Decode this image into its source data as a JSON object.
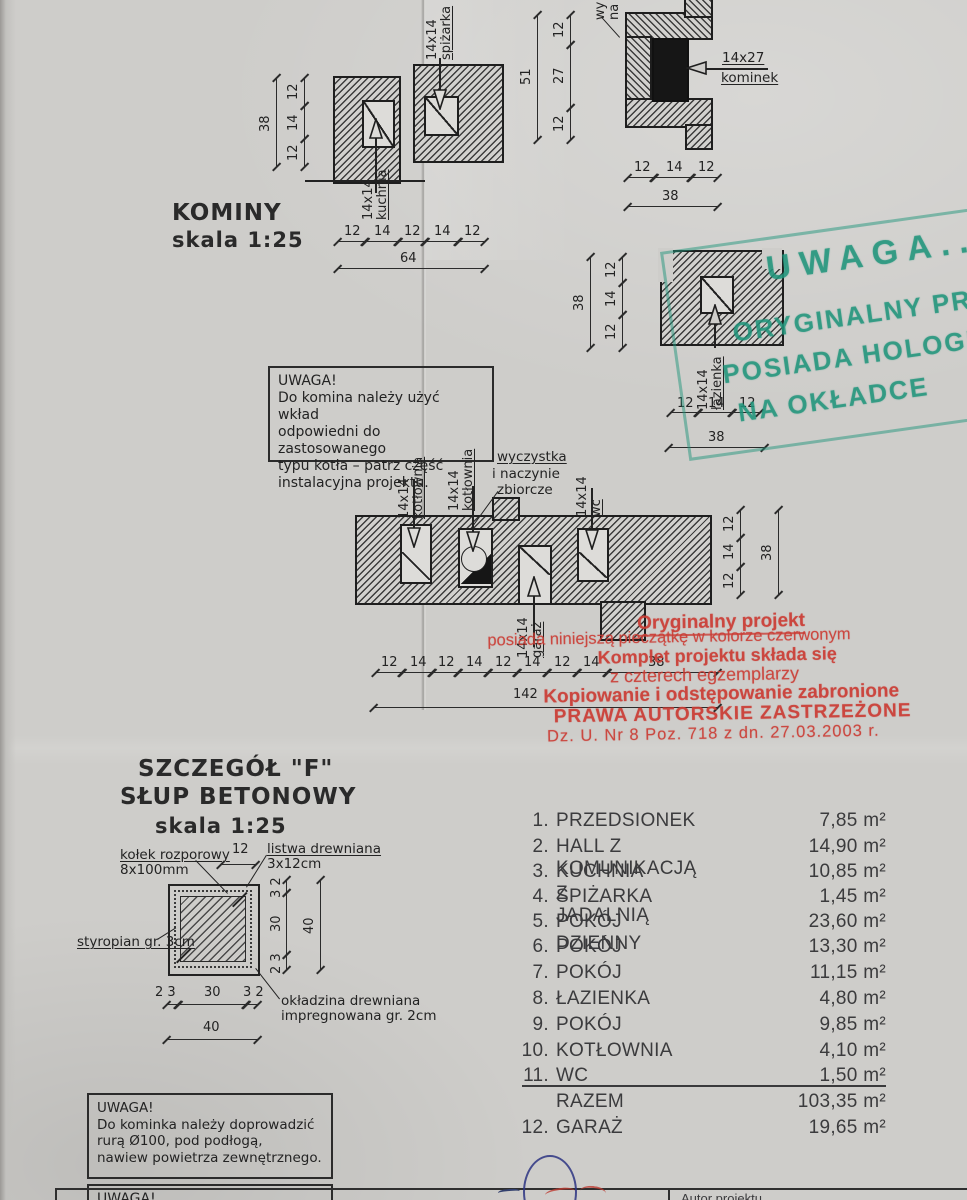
{
  "kominy": {
    "title": "KOMINY",
    "scale": "skala 1:25",
    "c1": {
      "flue_top_label1": "14x14",
      "flue_top_label2": "spiżarka",
      "flue_bottom_label1": "14x14",
      "flue_bottom_label2": "kuchnia",
      "dims_left": [
        "12",
        "14",
        "12"
      ],
      "dims_left_total": "38",
      "dims_bottom": [
        "12",
        "14",
        "12",
        "14",
        "12"
      ],
      "dims_bottom_total": "64"
    },
    "c2": {
      "flue_label1": "14x27",
      "flue_label2": "kominek",
      "partial_label1": "wy",
      "partial_label2": "na",
      "dims_left": [
        "12",
        "27",
        "12"
      ],
      "dims_left_total": "51",
      "dims_bottom": [
        "12",
        "14",
        "12"
      ],
      "dims_bottom_total": "38"
    },
    "c3": {
      "flue_label1": "14x14",
      "flue_label2": "łazienka",
      "dims_left": [
        "12",
        "14",
        "12"
      ],
      "dims_left_total": "38",
      "dims_bottom": [
        "12",
        "14",
        "12"
      ],
      "dims_bottom_total": "38"
    },
    "c4": {
      "flue1_label1": "14x14",
      "flue1_label2": "kotłownia",
      "flue2_label1": "14x14",
      "flue2_label2": "kotłownia",
      "wyczystka_line1": "wyczystka",
      "wyczystka_line2": "i naczynie",
      "wyczystka_line3": "zbiorcze",
      "wc_label1": "14x14",
      "wc_label2": "wc",
      "garaz_label1": "14x14",
      "garaz_label2": "garaż",
      "dims_right": [
        "12",
        "14",
        "12"
      ],
      "dims_right_total": "38",
      "dims_bottom": [
        "12",
        "14",
        "12",
        "14",
        "12",
        "14",
        "12",
        "14",
        "38"
      ],
      "dims_bottom_total": "142"
    }
  },
  "note_komin": {
    "title": "UWAGA!",
    "line1": "Do komina należy użyć wkład",
    "line2": "odpowiedni do zastosowanego",
    "line3": "typu kotła – patrz część",
    "line4": "instalacyjna projektu."
  },
  "green_stamp": {
    "line1": "UWAGA..!",
    "line2": "ORYGINALNY PROJEKT",
    "line3": "POSIADA HOLOGRAM",
    "line4": "NA OKŁADCE",
    "color": "#21967c"
  },
  "red_stamp": {
    "line1": "Oryginalny projekt",
    "line2": "posiada niniejszą pieczątkę w kolorze czerwonym",
    "line3": "Komplet projektu składa się",
    "line4": "z czterech egzemplarzy",
    "line5": "Kopiowanie i odstępowanie zabronione",
    "line6": "PRAWA AUTORSKIE ZASTRZEŻONE",
    "line7": "Dz. U. Nr 8 Poz. 718 z dn. 27.03.2003 r.",
    "color": "#cc4a42"
  },
  "detail_f": {
    "title1": "SZCZEGÓŁ \"F\"",
    "title2": "SŁUP BETONOWY",
    "scale": "skala 1:25",
    "callout_kolek1": "kołek rozporowy",
    "callout_kolek2": "8x100mm",
    "callout_listwa1": "listwa drewniana",
    "callout_listwa2": "3x12cm",
    "callout_styropian": "styropian gr. 3cm",
    "callout_okladzina1": "okładzina drewniana",
    "callout_okladzina2": "impregnowana gr. 2cm",
    "dim_top": "12",
    "dims_right": [
      "3 2",
      "30",
      "2 3"
    ],
    "dims_right_total": "40",
    "dims_bottom": [
      "2 3",
      "30",
      "3 2"
    ],
    "dims_bottom_total": "40"
  },
  "rooms": {
    "rows": [
      {
        "num": "1.",
        "name": "PRZEDSIONEK",
        "area": "7,85 m²"
      },
      {
        "num": "2.",
        "name": "HALL Z KOMUNIKACJĄ",
        "area": "14,90 m²"
      },
      {
        "num": "3.",
        "name": "KUCHNIA Z JADALNIĄ",
        "area": "10,85 m²"
      },
      {
        "num": "4.",
        "name": "SPIŻARKA",
        "area": "1,45 m²"
      },
      {
        "num": "5.",
        "name": "POKÓJ DZIENNY",
        "area": "23,60 m²"
      },
      {
        "num": "6.",
        "name": "POKÓJ",
        "area": "13,30 m²"
      },
      {
        "num": "7.",
        "name": "POKÓJ",
        "area": "11,15 m²"
      },
      {
        "num": "8.",
        "name": "ŁAZIENKA",
        "area": "4,80 m²"
      },
      {
        "num": "9.",
        "name": "POKÓJ",
        "area": "9,85 m²"
      },
      {
        "num": "10.",
        "name": "KOTŁOWNIA",
        "area": "4,10 m²"
      },
      {
        "num": "11.",
        "name": "WC",
        "area": "1,50 m²"
      }
    ],
    "total_label": "RAZEM",
    "total_area": "103,35 m²",
    "garage_num": "12.",
    "garage_name": "GARAŻ",
    "garage_area": "19,65 m²"
  },
  "note_kominek": {
    "title": "UWAGA!",
    "line1": "Do kominka należy doprowadzić",
    "line2": "rurą Ø100, pod podłogą,",
    "line3": "nawiew powietrza zewnętrznego."
  },
  "note_bottom": {
    "title": "UWAGA!"
  },
  "titleblock": {
    "autor_label": "Autor projektu"
  }
}
